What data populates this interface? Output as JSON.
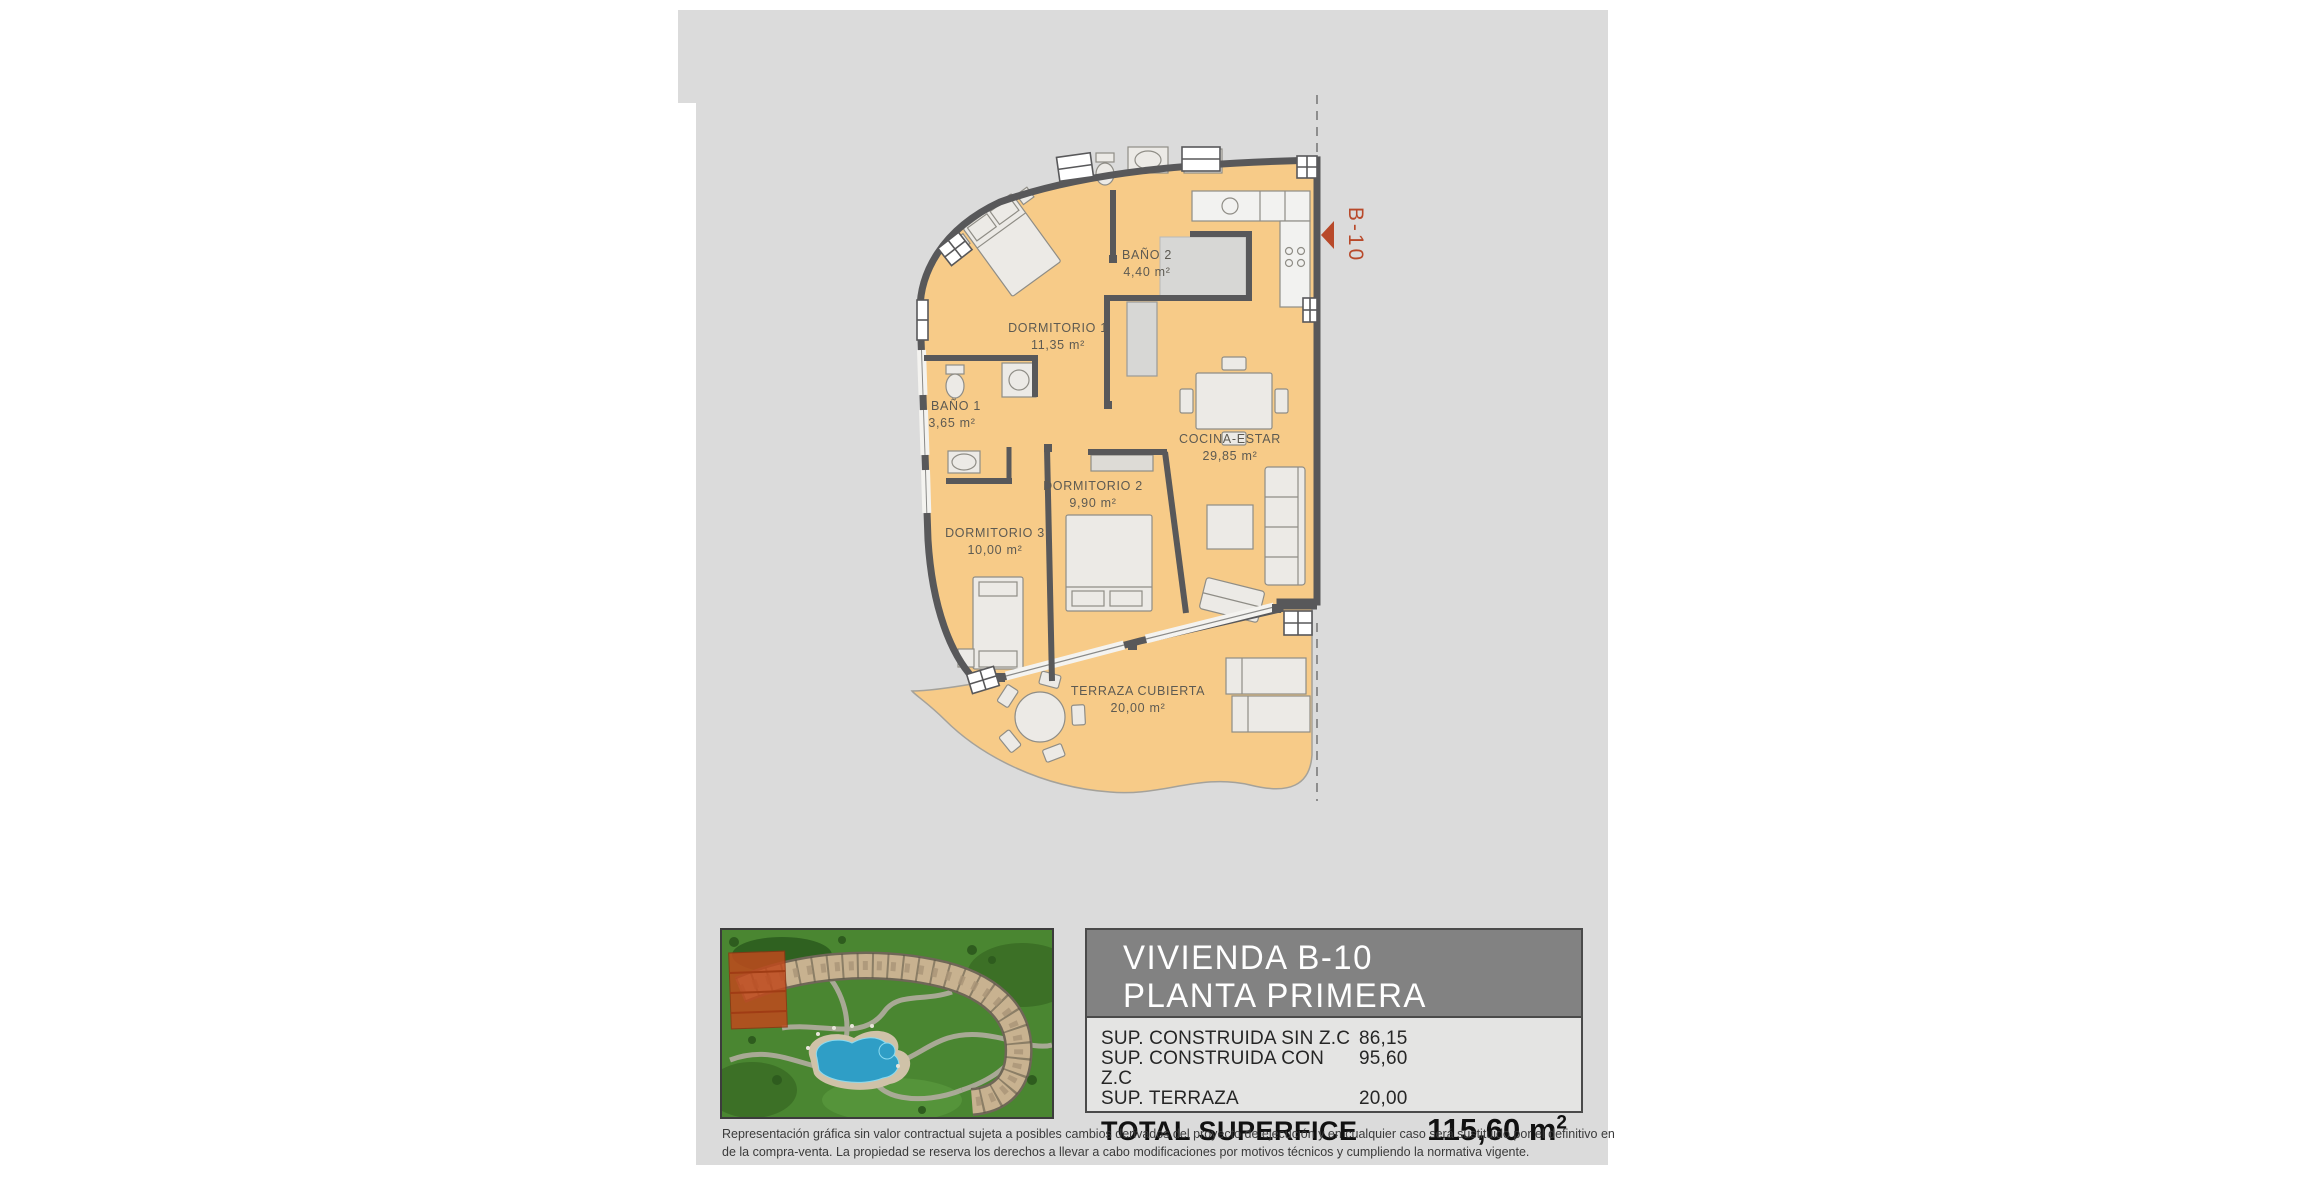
{
  "document": {
    "background": "#dbdbdb",
    "plan": {
      "unit_marker": "B-10",
      "accent_color": "#b8492a",
      "floor_color": "#f7cb88",
      "wall_color": "#58585a",
      "rooms": [
        {
          "name": "BAÑO 2",
          "area": "4,40 m²"
        },
        {
          "name": "DORMITORIO 1",
          "area": "11,35 m²"
        },
        {
          "name": "BAÑO 1",
          "area": "3,65 m²"
        },
        {
          "name": "COCINA-ESTAR",
          "area": "29,85 m²"
        },
        {
          "name": "DORMITORIO 2",
          "area": "9,90 m²"
        },
        {
          "name": "DORMITORIO 3",
          "area": "10,00 m²"
        },
        {
          "name": "TERRAZA CUBIERTA",
          "area": "20,00 m²"
        }
      ]
    },
    "title_block": {
      "title_line1": "VIVIENDA B-10",
      "title_line2": "PLANTA PRIMERA",
      "rows": [
        {
          "label": "SUP. CONSTRUIDA SIN Z.C",
          "value": "86,15"
        },
        {
          "label": "SUP. CONSTRUIDA CON Z.C",
          "value": "95,60"
        },
        {
          "label": "SUP. TERRAZA",
          "value": "20,00"
        }
      ],
      "total_label": "TOTAL SUPERFICE",
      "total_value": "115,60 m",
      "total_superscript": "2"
    },
    "disclaimer": {
      "line1": "Representación gráfica sin valor contractual sujeta a posibles cambios derivados del proyecto de ejecución y en cualquier caso será sustituido por el definitivo en",
      "line2": "de la compra-venta. La propiedad se reserva los derechos a llevar a cabo modificaciones por motivos técnicos y cumpliendo la normativa vigente."
    }
  }
}
